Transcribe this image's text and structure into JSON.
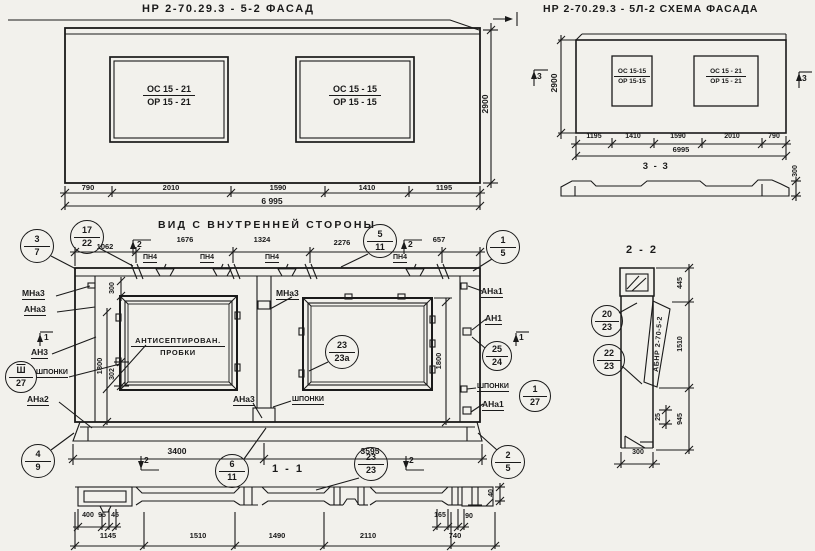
{
  "drawing": {
    "facade": {
      "title": "НР 2-70.29.3 - 5-2    ФАСАД",
      "height": "2900",
      "win_left": [
        "ОС 15 - 21",
        "ОР 15 - 21"
      ],
      "win_right": [
        "ОС 15 - 15",
        "ОР 15 - 15"
      ],
      "segs": [
        "790",
        "2010",
        "1590",
        "1410",
        "1195"
      ],
      "total": "6 995"
    },
    "schema": {
      "title": "НР 2-70.29.3 - 5Л-2  СХЕМА ФАСАДА",
      "height": "2900",
      "win_left": [
        "ОС 15-15",
        "ОР 15-15"
      ],
      "win_right": [
        "ОС 15 - 21",
        "ОР 15 - 21"
      ],
      "segs": [
        "1195",
        "1410",
        "1590",
        "2010",
        "790"
      ],
      "total": "6995",
      "flag": "3",
      "section_title": "3 - 3",
      "depth": "300"
    },
    "inner": {
      "title": "ВИД С ВНУТРЕННЕЙ СТОРОНЫ",
      "top_dims": [
        "1062",
        "1676",
        "1324",
        "2276",
        "657"
      ],
      "pn4": "ПН4",
      "flag1": "1",
      "flag2": "2",
      "note": [
        "АНТИСЕПТИРОВАН.",
        "ПРОБКИ"
      ],
      "lbl": {
        "mna3": "МНа3",
        "ana3": "АНа3",
        "an3": "АН3",
        "shponki": "ШПОНКИ",
        "ana2": "АНа2",
        "ana1": "АНа1",
        "an1": "АН1"
      },
      "v300": "300",
      "v302": "302",
      "v1800": "1800",
      "bottom_dims": [
        "3400",
        "3595"
      ],
      "section_title": "1 - 1"
    },
    "s11": {
      "small_left": [
        "400",
        "95",
        "45"
      ],
      "small_right": [
        "165",
        "90"
      ],
      "v40": "40",
      "bottom_dims": [
        "1145",
        "1510",
        "1490",
        "2110",
        "740"
      ]
    },
    "s22": {
      "title": "2 - 2",
      "stamp": "АБНР 2-70-5-2",
      "dims": [
        "445",
        "1510",
        "945"
      ],
      "d25": "25",
      "d300": "300"
    },
    "callouts": {
      "c3_7": [
        "3",
        "7"
      ],
      "c17_22": [
        "17",
        "22"
      ],
      "c5_11": [
        "5",
        "11"
      ],
      "c1_5": [
        "1",
        "5"
      ],
      "csh27": [
        "Ш",
        "27"
      ],
      "c23_23a": [
        "23",
        "23а"
      ],
      "c25_24": [
        "25",
        "24"
      ],
      "c1_27": [
        "1",
        "27"
      ],
      "c4_9": [
        "4",
        "9"
      ],
      "c6_11": [
        "6",
        "11"
      ],
      "c23_23": [
        "23",
        "23"
      ],
      "c2_5": [
        "2",
        "5"
      ],
      "c20_23": [
        "20",
        "23"
      ],
      "c22_23": [
        "22",
        "23"
      ]
    },
    "colors": {
      "ink": "#1a1a1a",
      "paper": "#f2f1ec"
    }
  }
}
